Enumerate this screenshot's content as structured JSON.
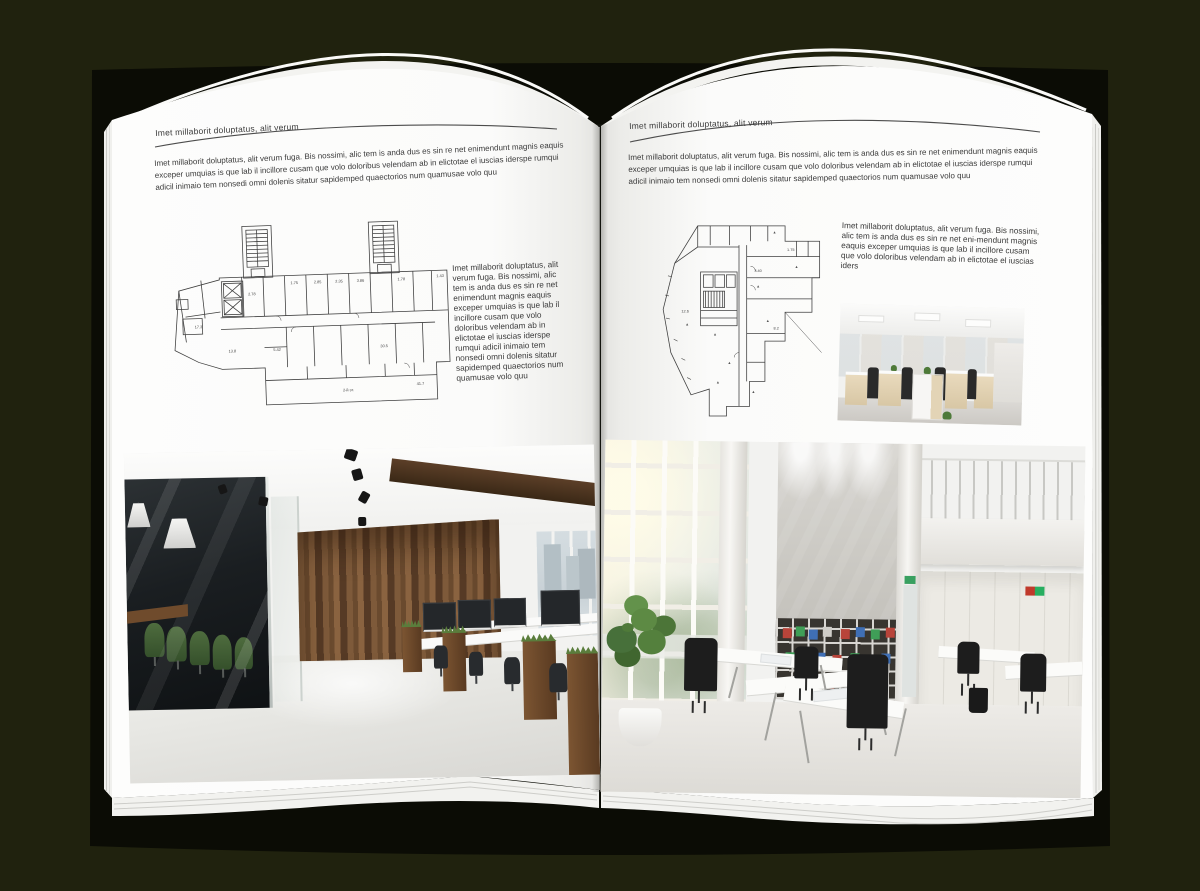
{
  "canvas": {
    "width": 1200,
    "height": 891,
    "background": "#20220e"
  },
  "colors": {
    "page": "#fdfdfc",
    "text": "#3a3a3a",
    "rule": "#4c4c4c",
    "cover": "#0b0c05",
    "wood": "#6a4a2e",
    "chair_green": "#47633a",
    "binder_red": "#b8443a",
    "binder_green": "#3f9e57",
    "binder_blue": "#3f6fb5"
  },
  "book": {
    "left_page": {
      "header": "Imet millaborit doluptatus, alit verum",
      "intro": "Imet millaborit doluptatus, alit verum fuga. Bis nossimi, alic tem is anda dus es sin re net enimendunt magnis eaquis exceper umquias is que lab il incillore cusam que volo doloribus velendam ab in elictotae el iuscias iderspe rumqui adicil inimaio tem nonsedi omni dolenis sitatur sapidemped quaectorios num quamusae volo quu",
      "side_text": "Imet millaborit doluptatus, alit verum fuga. Bis nossimi, alic tem is anda dus es sin re net enimendunt magnis eaquis exceper umquias is que lab il incillore cusam que volo doloribus velendam ab in elictotae el iuscias iderspe rumqui adicil inimaio tem nonsedi omni dolenis sitatur sapidemped quaectorios num quamusae volo quu",
      "floor_plan_labels": [
        "2.78",
        "1.75",
        "2.85",
        "2.35",
        "3.86",
        "1.78",
        "1.43",
        "17.3",
        "13.8",
        "30.5",
        "41.7",
        "5.42",
        "2-й эт."
      ],
      "photo_name": "office-interior-wood-and-glass"
    },
    "right_page": {
      "header": "Imet millaborit doluptatus, alit verum",
      "intro": "Imet millaborit doluptatus, alit verum fuga. Bis nossimi, alic tem is anda dus es sin re net enimendunt magnis eaquis exceper umquias is que lab il incillore cusam que volo doloribus velendam ab in elictotae el iuscias iderspe rumqui adicil inimaio tem nonsedi omni dolenis sitatur sapidemped quaectorios num quamusae volo quu",
      "side_text": "Imet millaborit doluptatus, alit verum fuga. Bis nossimi, alic tem is anda dus es sin re net eni-mendunt magnis eaquis exceper umquias is que lab il incillore cusam que volo doloribus velendam ab in elictotae el iuscias iders",
      "floor_plan_labels": [
        "1.75",
        "3.40",
        "12.6",
        "8.2"
      ],
      "photo_small_name": "office-interior-open-desks",
      "photo_large_name": "office-interior-loft-atrium"
    }
  }
}
